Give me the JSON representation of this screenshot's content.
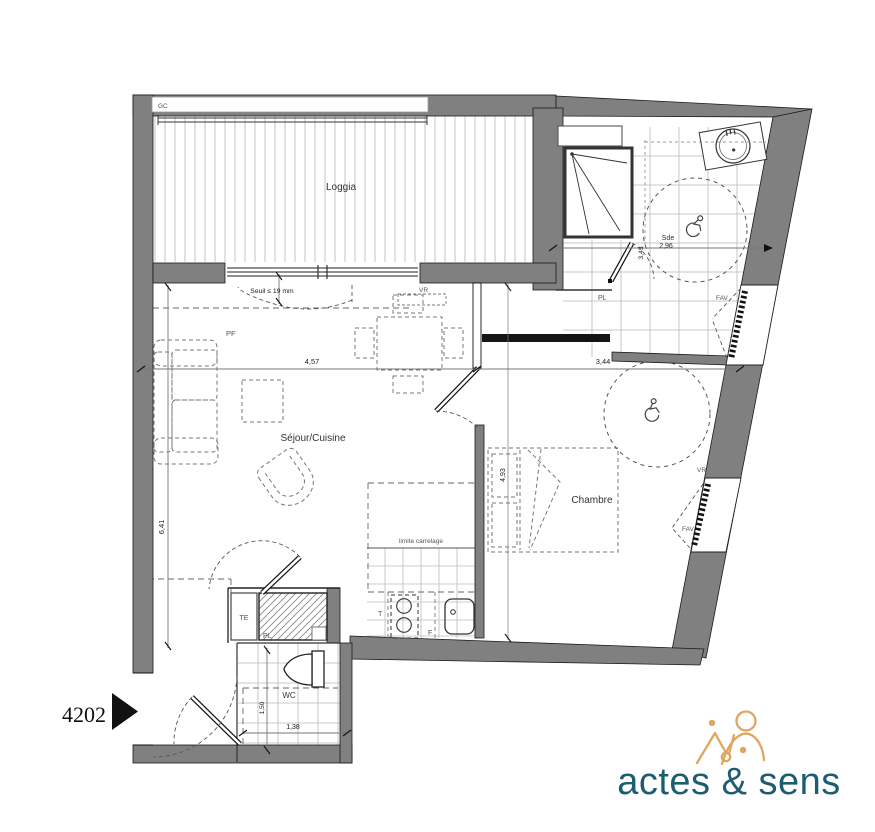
{
  "plan": {
    "unit_number": "4202",
    "rooms": {
      "loggia": "Loggia",
      "sejour": "Séjour/Cuisine",
      "chambre": "Chambre",
      "sde": "Sde",
      "wc": "WC"
    },
    "labels": {
      "gc": "GC",
      "pf": "PF",
      "vr": "VR",
      "pl": "PL",
      "te": "TE",
      "fav": "FAV",
      "t": "T",
      "f": "F",
      "seuil": "Seuil ≤ 19 mm",
      "limite": "limite carrelage"
    },
    "dims": {
      "sejour_w": "4,57",
      "hall_w": "3,44",
      "sejour_h": "6,41",
      "chambre_h": "4,93",
      "sde_w": "2,96",
      "sde_h": "3,43",
      "wc_w": "1,38",
      "wc_h": "1,50"
    }
  },
  "logo": {
    "name": "actes & sens",
    "text_color": "#1d5d72",
    "mark_color": "#dfa661"
  },
  "colors": {
    "wall": "#808080",
    "line": "#222222",
    "tile": "#b9b9b9",
    "dash": "#666666"
  }
}
